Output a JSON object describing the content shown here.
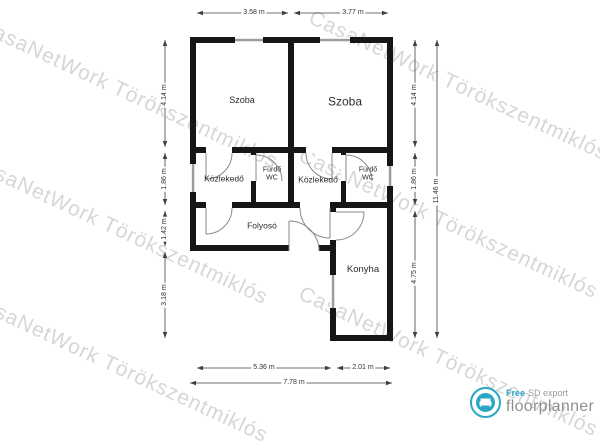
{
  "watermark": {
    "text": "CasaNetWork Törökszentmiklós",
    "color": "#bdbdbd"
  },
  "rooms": {
    "szoba_left": "Szoba",
    "szoba_right": "Szoba",
    "kozlekedo_left": "Közlekedő",
    "kozlekedo_right": "Közlekedő",
    "furdo_left": "Fürdő WC",
    "furdo_right": "Fürdő WC",
    "folyoso": "Folyosó",
    "konyha": "Konyha"
  },
  "dimensions": {
    "top_left": "3.58 m",
    "top_right": "3.77 m",
    "left_1": "4.14 m",
    "left_2": "1.86 m",
    "left_3": "1.42 m",
    "left_4": "3.18 m",
    "right_1": "4.14 m",
    "right_2": "1.86 m",
    "right_3": "4.75 m",
    "right_total": "11.46 m",
    "bottom_left": "5.36 m",
    "bottom_right": "2.01 m",
    "bottom_total": "7.78 m"
  },
  "logo": {
    "free": "Free",
    "export": "SD export",
    "brand": "floorplanner",
    "accent_color": "#2ba7c6"
  },
  "colors": {
    "wall": "#161616",
    "window": "#9d9d9d",
    "dimension_line": "#3f3f3f",
    "door": "#8a8a8a"
  }
}
